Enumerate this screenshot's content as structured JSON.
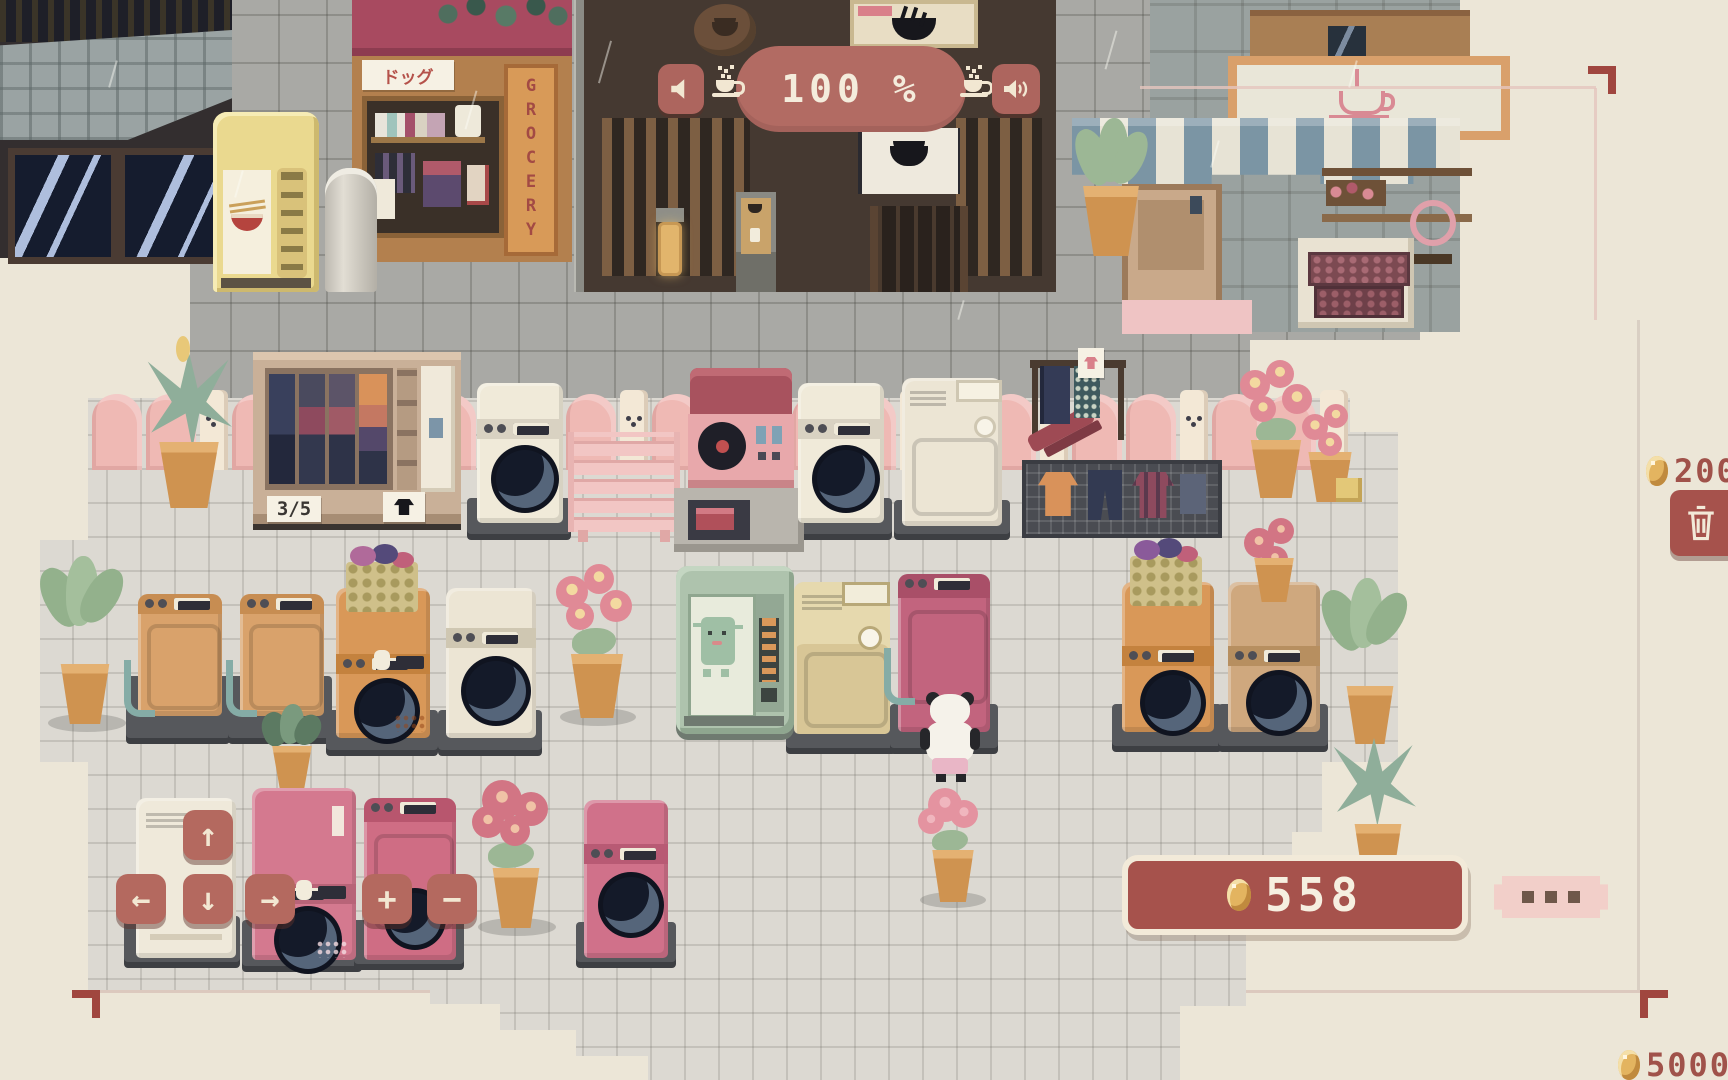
{
  "hud": {
    "volume_display": {
      "value": "100 %"
    },
    "music_button": {
      "icon": "speaker-muted-icon"
    },
    "sfx_button": {
      "icon": "speaker-waves-icon"
    },
    "left_cup": {
      "icon": "coffee-cup-icon"
    },
    "right_cup": {
      "icon": "coffee-cup-icon"
    },
    "sell_offer": {
      "coin_icon": "coin-icon",
      "price": "200"
    },
    "trash_button": {
      "icon": "trash-icon"
    },
    "wallet": {
      "coin_icon": "coin-icon",
      "balance": "558"
    },
    "more_button": {
      "icon": "ellipsis-icon"
    },
    "expansion_offer": {
      "coin_icon": "coin-icon",
      "price": "5000"
    },
    "move_controls": {
      "up": "↑",
      "left": "←",
      "down": "↓",
      "right": "→",
      "add": "+",
      "remove": "−"
    }
  },
  "shops": {
    "grocery": {
      "awning_sign": "ドッグ",
      "vertical_sign": "GROCERY"
    },
    "cafe": {
      "sign_icon": "coffee-cup-icon"
    },
    "ramen": {
      "poster_icon": "ramen-bowl-icon",
      "noren_icon": "ramen-bowl-icon"
    }
  },
  "laundromat": {
    "storage_shelf": {
      "capacity": "3/5",
      "tag_icon": "shirt-icon"
    }
  },
  "colors": {
    "hud_red": "#b26b63",
    "panel_red": "#a6524c",
    "cream": "#f2ead9",
    "coin_gold": "#e3b460",
    "price_text": "#a0524a",
    "pink_button": "#f2cfc9",
    "floor": "#dcd9d2",
    "street": "#a9a9a5",
    "fence_pink": "#efb9b4"
  }
}
